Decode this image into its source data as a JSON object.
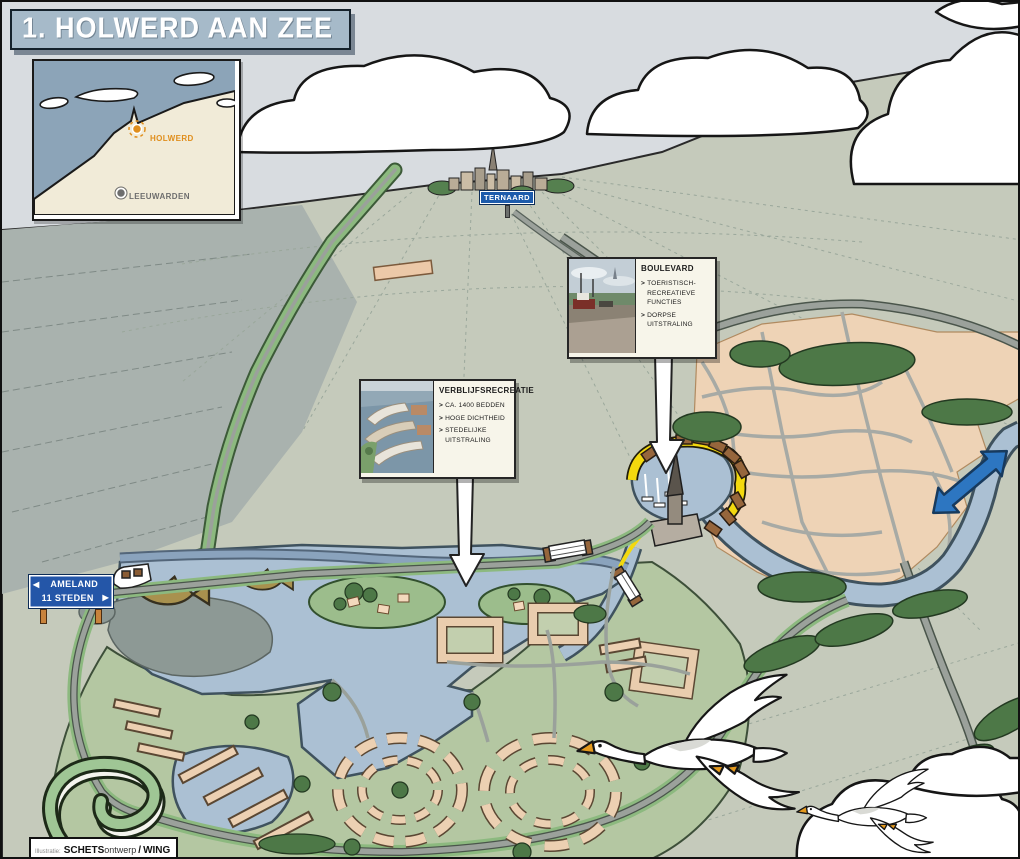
{
  "title": "1. HOLWERD AAN ZEE",
  "inset_map": {
    "place_primary": "HOLWERD",
    "place_secondary": "LEEUWARDEN"
  },
  "signs": {
    "ternaard": "TERNAARD",
    "ameland_line1": "AMELAND",
    "ameland_line2": "11 STEDEN",
    "arrow_left": "◀",
    "arrow_right": "▶"
  },
  "callouts": {
    "bullet_char": ">",
    "boulevard": {
      "title": "BOULEVARD",
      "bullets": [
        "TOERISTISCH-RECREATIEVE FUNCTIES",
        "DORPSE UITSTRALING"
      ]
    },
    "verblijfsrecreatie": {
      "title": "VERBLIJFSRECREATIE",
      "bullets": [
        "CA. 1400 BEDDEN",
        "HOGE DICHTHEID",
        "STEDELIJKE UITSTRALING"
      ]
    }
  },
  "credit": {
    "prefix": "Illustratie:",
    "brand_bold": "SCHETS",
    "brand_light": "ontwerp",
    "separator": "/",
    "partner": "WING"
  },
  "colors": {
    "sky": "#d8dce0",
    "field": "#c5cabb",
    "marsh": "#9ba8a6",
    "water": "#abc0d3",
    "mudflat": "#8d9995",
    "village": "#eed3b6",
    "boulevard_yellow": "#f3d90e",
    "quay_brown": "#96663c",
    "tree_green": "#4d7847",
    "dev_green": "#b4c7a2",
    "verge_green": "#8cb97f",
    "road_gray": "#9ba19b",
    "arrow_blue": "#2d76c1",
    "sign_blue": "#2456a8",
    "banner_blue": "#a6bac9",
    "holwerd_orange": "#e08e1c"
  }
}
